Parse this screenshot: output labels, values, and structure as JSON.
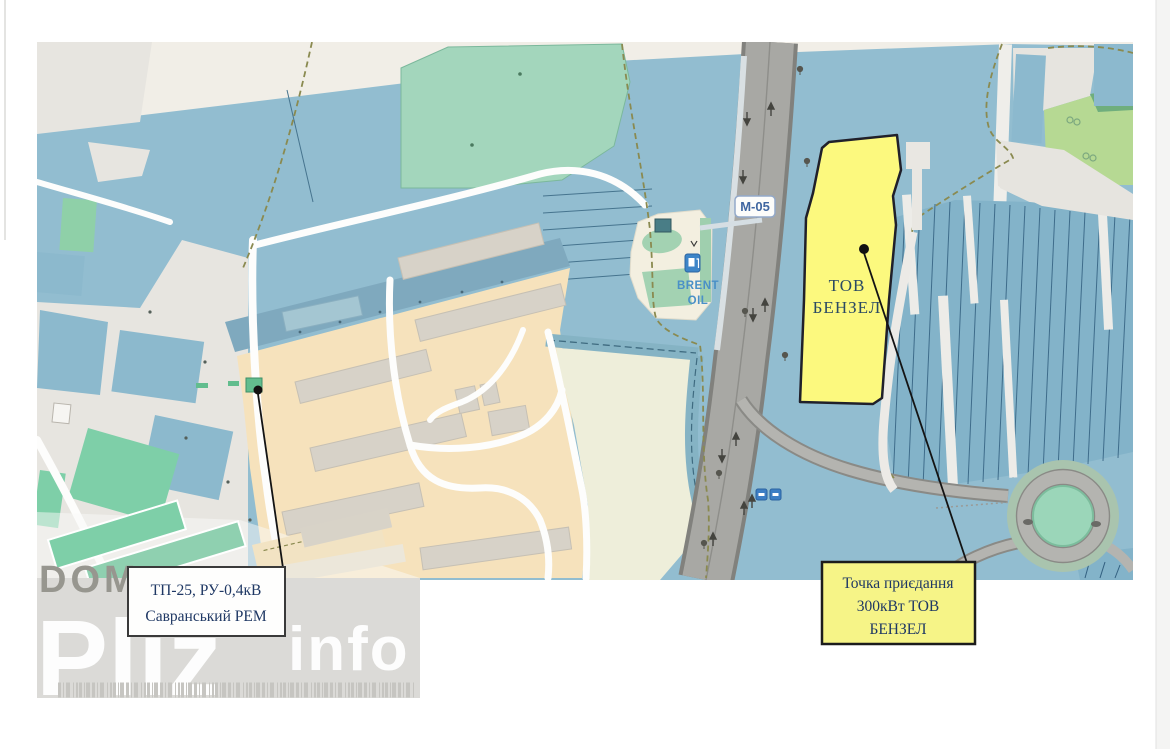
{
  "window": {
    "width": 1170,
    "height": 749
  },
  "map": {
    "road_shield_label": "М-05",
    "gas_station": {
      "name_line1": "BRENT",
      "name_line2": "OIL"
    },
    "target_parcel": {
      "label_line1": "ТОВ",
      "label_line2": "БЕНЗЕЛ"
    },
    "tp_label_box": {
      "line1": "ТП-25, РУ-0,4кВ",
      "line2": "Савранський РЕМ"
    },
    "connection_label_box": {
      "line1": "Точка приєдання",
      "line2": "300кВт ТОВ",
      "line3": "БЕНЗЕЛ"
    },
    "colors": {
      "field_blue": "#92bdd0",
      "parcel_blue": "#83b3c9",
      "farmland_beige": "#f6e2bc",
      "grass_green": "#a3d6bc",
      "highlight_yellow": "#fcf97e",
      "label_yellow": "#f6f487",
      "label_text_navy": "#1f3864",
      "road_gray": "#a8a8a4"
    }
  },
  "watermark": {
    "word1": "DOM",
    "word2": "Pliz",
    "word3": "info"
  }
}
